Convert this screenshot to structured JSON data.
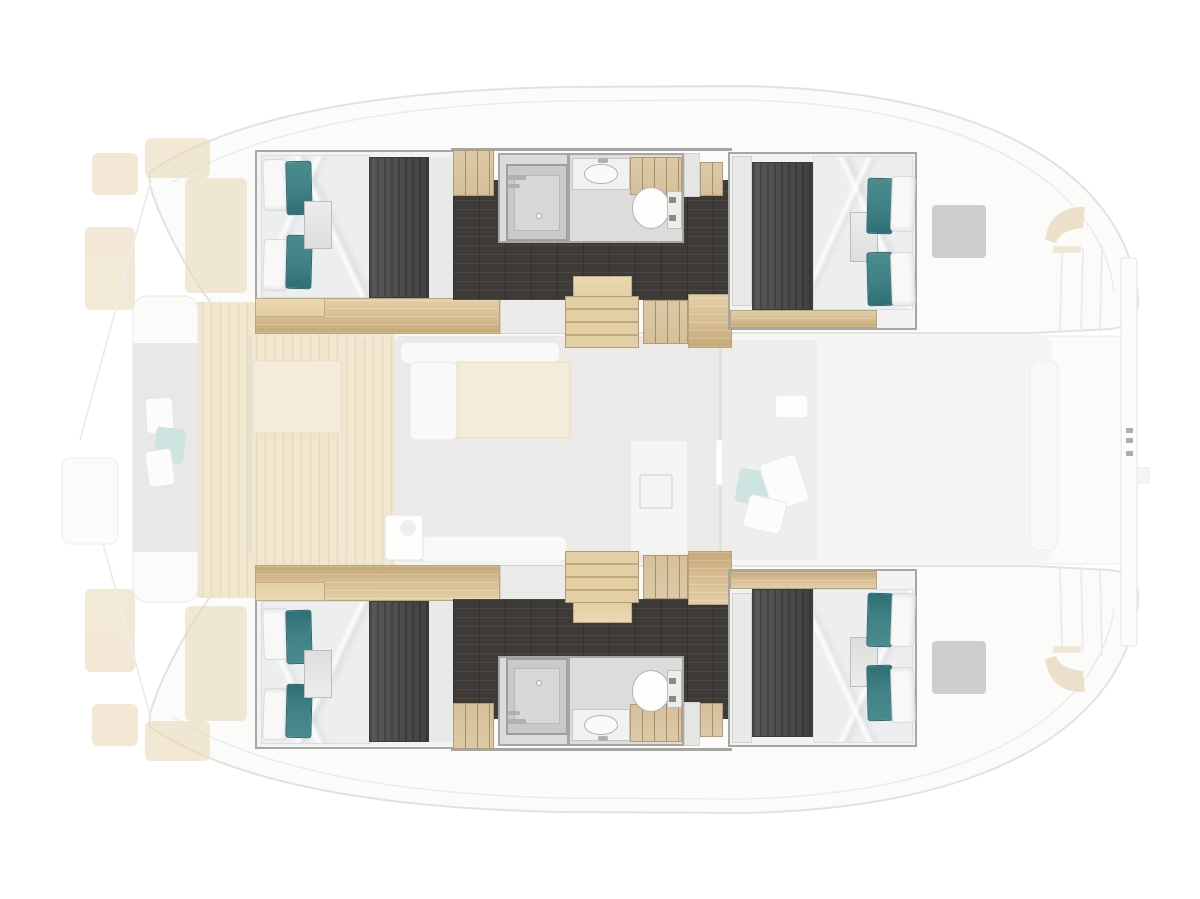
{
  "diagram": {
    "kind": "catamaran-yacht-floor-plan",
    "view": "top-down deck plan, bow at left, stern at right",
    "highlighted_level": "hull accommodations (cabins and bathrooms) shown at full opacity; main deck, salon, cockpit and foredeck shown faded"
  },
  "regions": {
    "hull_top": [
      "forward-double-cabin",
      "bathroom-with-shower-sink-toilet",
      "corridor",
      "companionway-steps",
      "aft-double-cabin"
    ],
    "hull_bottom": [
      "forward-double-cabin",
      "bathroom-with-shower-sink-toilet",
      "corridor",
      "companionway-steps",
      "aft-double-cabin"
    ],
    "deck": [
      "foredeck-sunpads",
      "forward-cockpit-bench",
      "wood-foredeck",
      "salon-sofa-and-table",
      "nav-desk",
      "galley",
      "aft-cockpit-with-pillows",
      "transom-steps",
      "stern-hatches",
      "davit-crossbeam"
    ]
  },
  "colors": {
    "background": "#ffffff",
    "hull_fill": "#fbfbfa",
    "hull_stroke": "#e2e2e0",
    "deck_wood": "#f1e6ce",
    "deck_wood_grain": "#e6d8ba",
    "salon_floor": "#e7e6e4",
    "table_beige": "#f3ecd8",
    "sofa_white": "#f9f9f8",
    "cockpit_floor": "#f5f5f4",
    "cockpit_inner": "#ececeb",
    "pale_teal": "#cde4e0",
    "bow_pad": "#eadaba",
    "hatch": "#c6c6c5",
    "stern_wedge": "#e5d4b5",
    "davit": "#fcfcfb",
    "wall": "#a6a6a4",
    "cabin_bg": "#f2f2f3",
    "duvet": "#edeef0",
    "pillow_white": "#f8f8f8",
    "pillow_teal": "#3f8184",
    "pillow_teal_dark": "#2f6f75",
    "runner": "#4a4a4c",
    "corridor": "#3e3a37",
    "wood": "#d6bc90",
    "wood_dark": "#c4a878",
    "wood_light": "#e3cfa6",
    "cabinet": "#d5c09b",
    "cabinet_line": "#a98f66",
    "bath_floor": "#dcdcda",
    "shower_tray": "#c9c9c7",
    "shower_inner": "#d8d8d6",
    "fixture": "#f1f1f0"
  }
}
